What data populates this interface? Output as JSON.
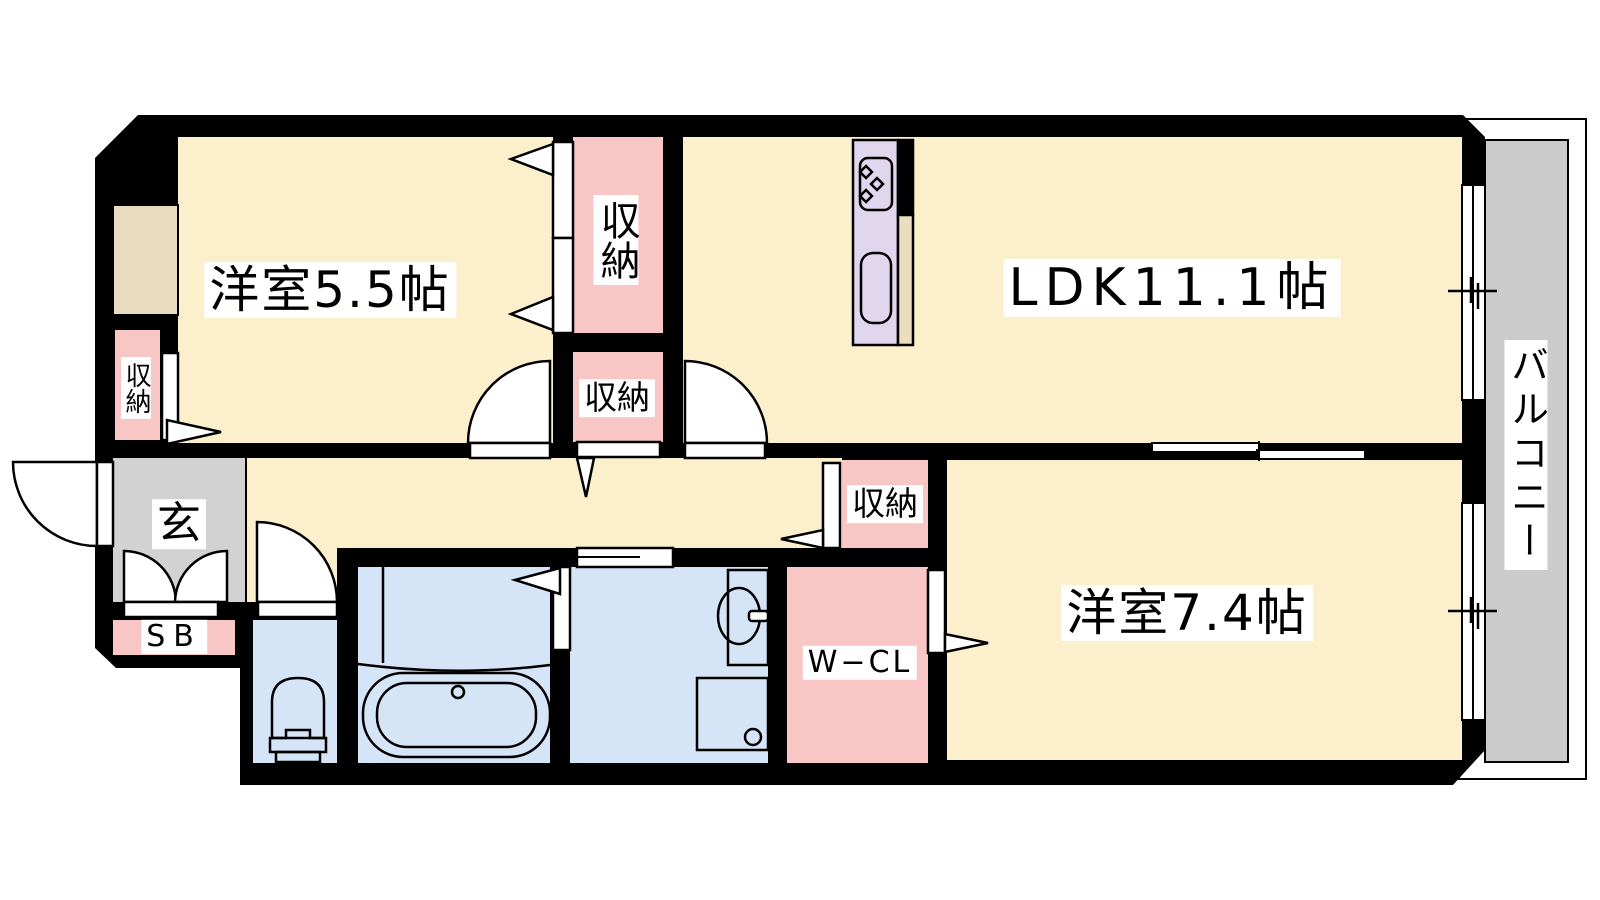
{
  "floorplan": {
    "rooms": {
      "western_5_5": {
        "label": "洋室5.5帖"
      },
      "ldk": {
        "label": "LDK11.1帖"
      },
      "western_7_4": {
        "label": "洋室7.4帖"
      },
      "balcony": {
        "label": "バルコニー"
      },
      "entrance": {
        "label": "玄"
      },
      "shoe_box": {
        "label": "SB"
      },
      "walk_in_closet": {
        "label": "W−CL"
      },
      "closet_bedroom_wall": {
        "label": "収納"
      },
      "closet_tall": {
        "label": "収納"
      },
      "closet_hall": {
        "label": "収納"
      },
      "closet_bedroom2": {
        "label": "収納"
      }
    },
    "colors": {
      "room_cream": "#FBEFCC",
      "closet_pink": "#F9C6C6",
      "wet_area_blue": "#D6E4F7",
      "entrance_gray": "#D2D2D2",
      "balcony_gray": "#CBCBCB",
      "kitchen_lavender": "#E0D6EE",
      "pipe_space_beige": "#EADCBE",
      "wall_black": "#000000"
    },
    "fixtures": [
      "gas-stove",
      "kitchen-sink",
      "bathtub",
      "toilet",
      "washbasin",
      "washing-machine"
    ]
  }
}
